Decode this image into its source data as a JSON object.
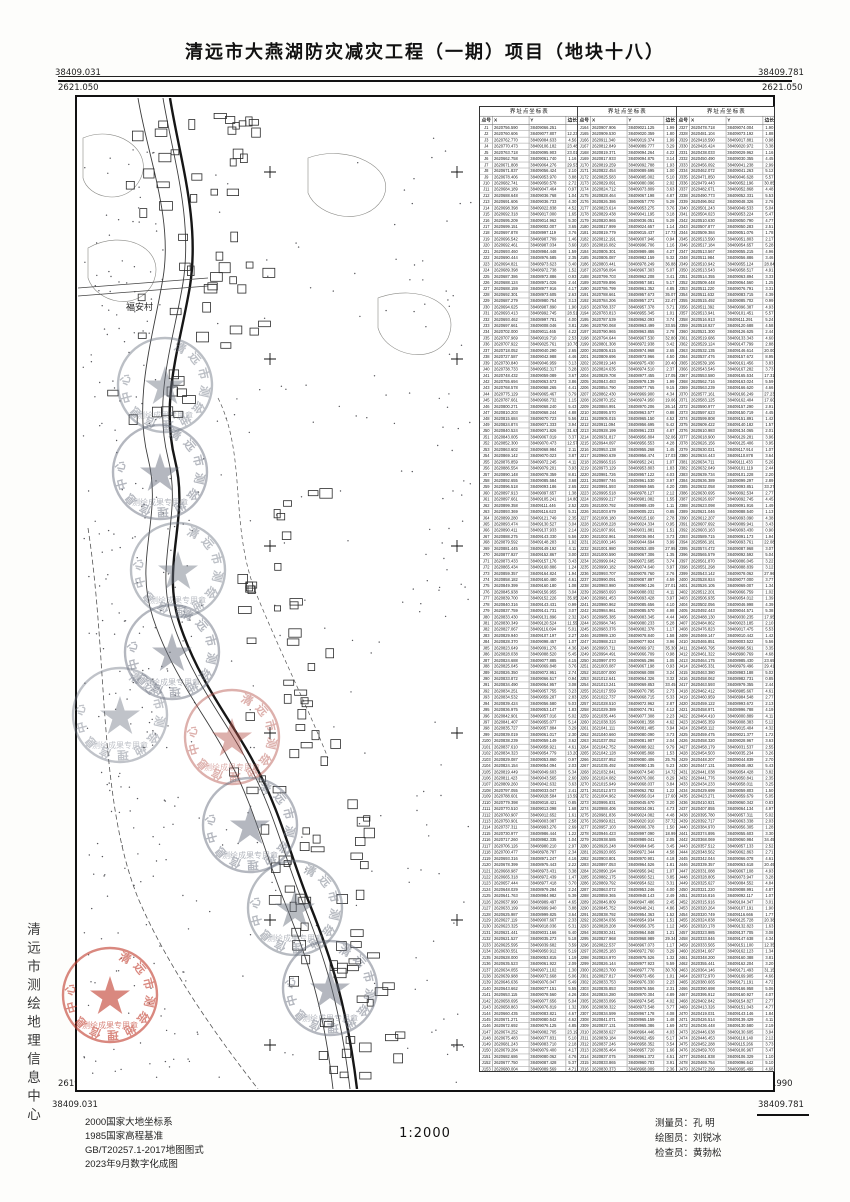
{
  "title": "清远市大燕湖防灾减灾工程（一期）项目（地块十八）",
  "scale_label": "1:2000",
  "side_text": "清远市测绘地理信息中心",
  "frame_labels": {
    "tl_e": "38409.031",
    "tl_n": "2621.050",
    "tr_e": "38409.781",
    "tr_n": "2621.050",
    "bl_n": "2619.990",
    "bl_e": "38409.031",
    "br_n": "2619.990",
    "br_e": "38409.781"
  },
  "footer": {
    "datum_lines": [
      "2000国家大地坐标系",
      "1985国家高程基准",
      "GB/T20257.1-2017地图图式",
      "2023年9月数字化成图"
    ],
    "staff": [
      {
        "role": "测量员：",
        "name": "孔  明"
      },
      {
        "role": "绘图员：",
        "name": "刘锐冰"
      },
      {
        "role": "检查员：",
        "name": "黄勃松"
      }
    ]
  },
  "map": {
    "village_label": "福安村",
    "stamp_ring_text": "清远市测绘地理信息中心",
    "stamp_bottom_text": "测绘成果专用章",
    "stamps": [
      {
        "x": 165,
        "y": 385,
        "color": "#6b7280",
        "opacity": 0.45
      },
      {
        "x": 160,
        "y": 472,
        "color": "#6b7280",
        "opacity": 0.5
      },
      {
        "x": 178,
        "y": 570,
        "color": "#6b7280",
        "opacity": 0.45
      },
      {
        "x": 172,
        "y": 652,
        "color": "#6b7280",
        "opacity": 0.5
      },
      {
        "x": 120,
        "y": 715,
        "color": "#6b7280",
        "opacity": 0.42
      },
      {
        "x": 232,
        "y": 737,
        "color": "#b5524a",
        "opacity": 0.45
      },
      {
        "x": 250,
        "y": 825,
        "color": "#6b7280",
        "opacity": 0.5
      },
      {
        "x": 295,
        "y": 908,
        "color": "#6b7280",
        "opacity": 0.48
      },
      {
        "x": 330,
        "y": 988,
        "color": "#6b7280",
        "opacity": 0.5
      },
      {
        "x": 110,
        "y": 995,
        "color": "#c03a2b",
        "opacity": 0.6
      }
    ]
  },
  "table": {
    "section_title": "界址点坐标表",
    "columns": [
      "点号",
      "X",
      "Y",
      "边长"
    ],
    "summary": "S=21214.94平方米 ≈31.822亩",
    "groups": [
      {
        "seed": 11,
        "start_index": 1,
        "count": 163,
        "x_base": 2620756.59,
        "y_base": 38409066.25,
        "known_rows": [
          [
            "J1",
            "2620756.590",
            "38409066.251",
            ""
          ],
          [
            "J2",
            "2620760.606",
            "38409077.807",
            "12.23"
          ],
          [
            "J3",
            "2620762.770",
            "38409084.633",
            "4.56"
          ],
          [
            "J4",
            "2620770.473",
            "38409106.182",
            "23.48"
          ],
          [
            "J5",
            "2620763.718",
            "38409095.903",
            "23.01"
          ]
        ]
      },
      {
        "seed": 23,
        "start_index": 164,
        "count": 163,
        "x_base": 2620907.91,
        "y_base": 38409021.13,
        "known_rows": [
          [
            "J164",
            "2620907.906",
            "38409021.125",
            "1.99"
          ],
          [
            "J165",
            "2620909.530",
            "38409020.359",
            "1.80"
          ],
          [
            "J166",
            "2620911.340",
            "38409019.374",
            "1.99"
          ]
        ]
      },
      {
        "seed": 37,
        "start_index": 327,
        "count": 162,
        "x_base": 2620478.72,
        "y_base": 38409074.0,
        "known_rows": [
          [
            "J327",
            "2620478.718",
            "38409074.004",
            "1.90"
          ],
          [
            "J328",
            "2620481.104",
            "38409073.192",
            "1.88"
          ]
        ],
        "closing_row": [
          "J1",
          "2620756.590",
          "38409066.251",
          "0.88"
        ]
      }
    ]
  }
}
